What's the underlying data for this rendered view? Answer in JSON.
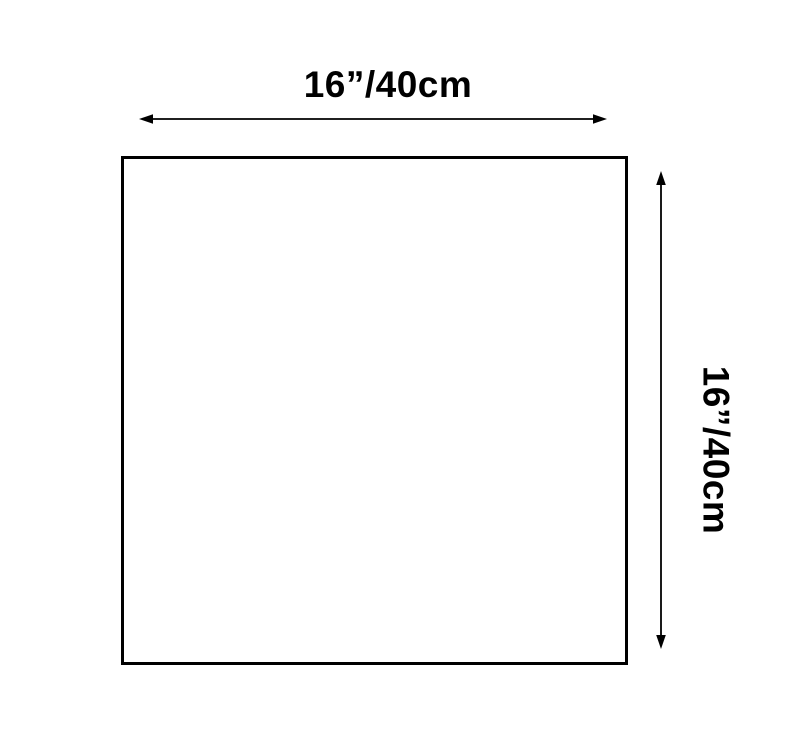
{
  "diagram": {
    "title": "square dimension diagram",
    "shape": "square",
    "width_label": "16”/40cm",
    "height_label": "16”/40cm",
    "line_color": "#000000",
    "background_color": "#ffffff"
  }
}
